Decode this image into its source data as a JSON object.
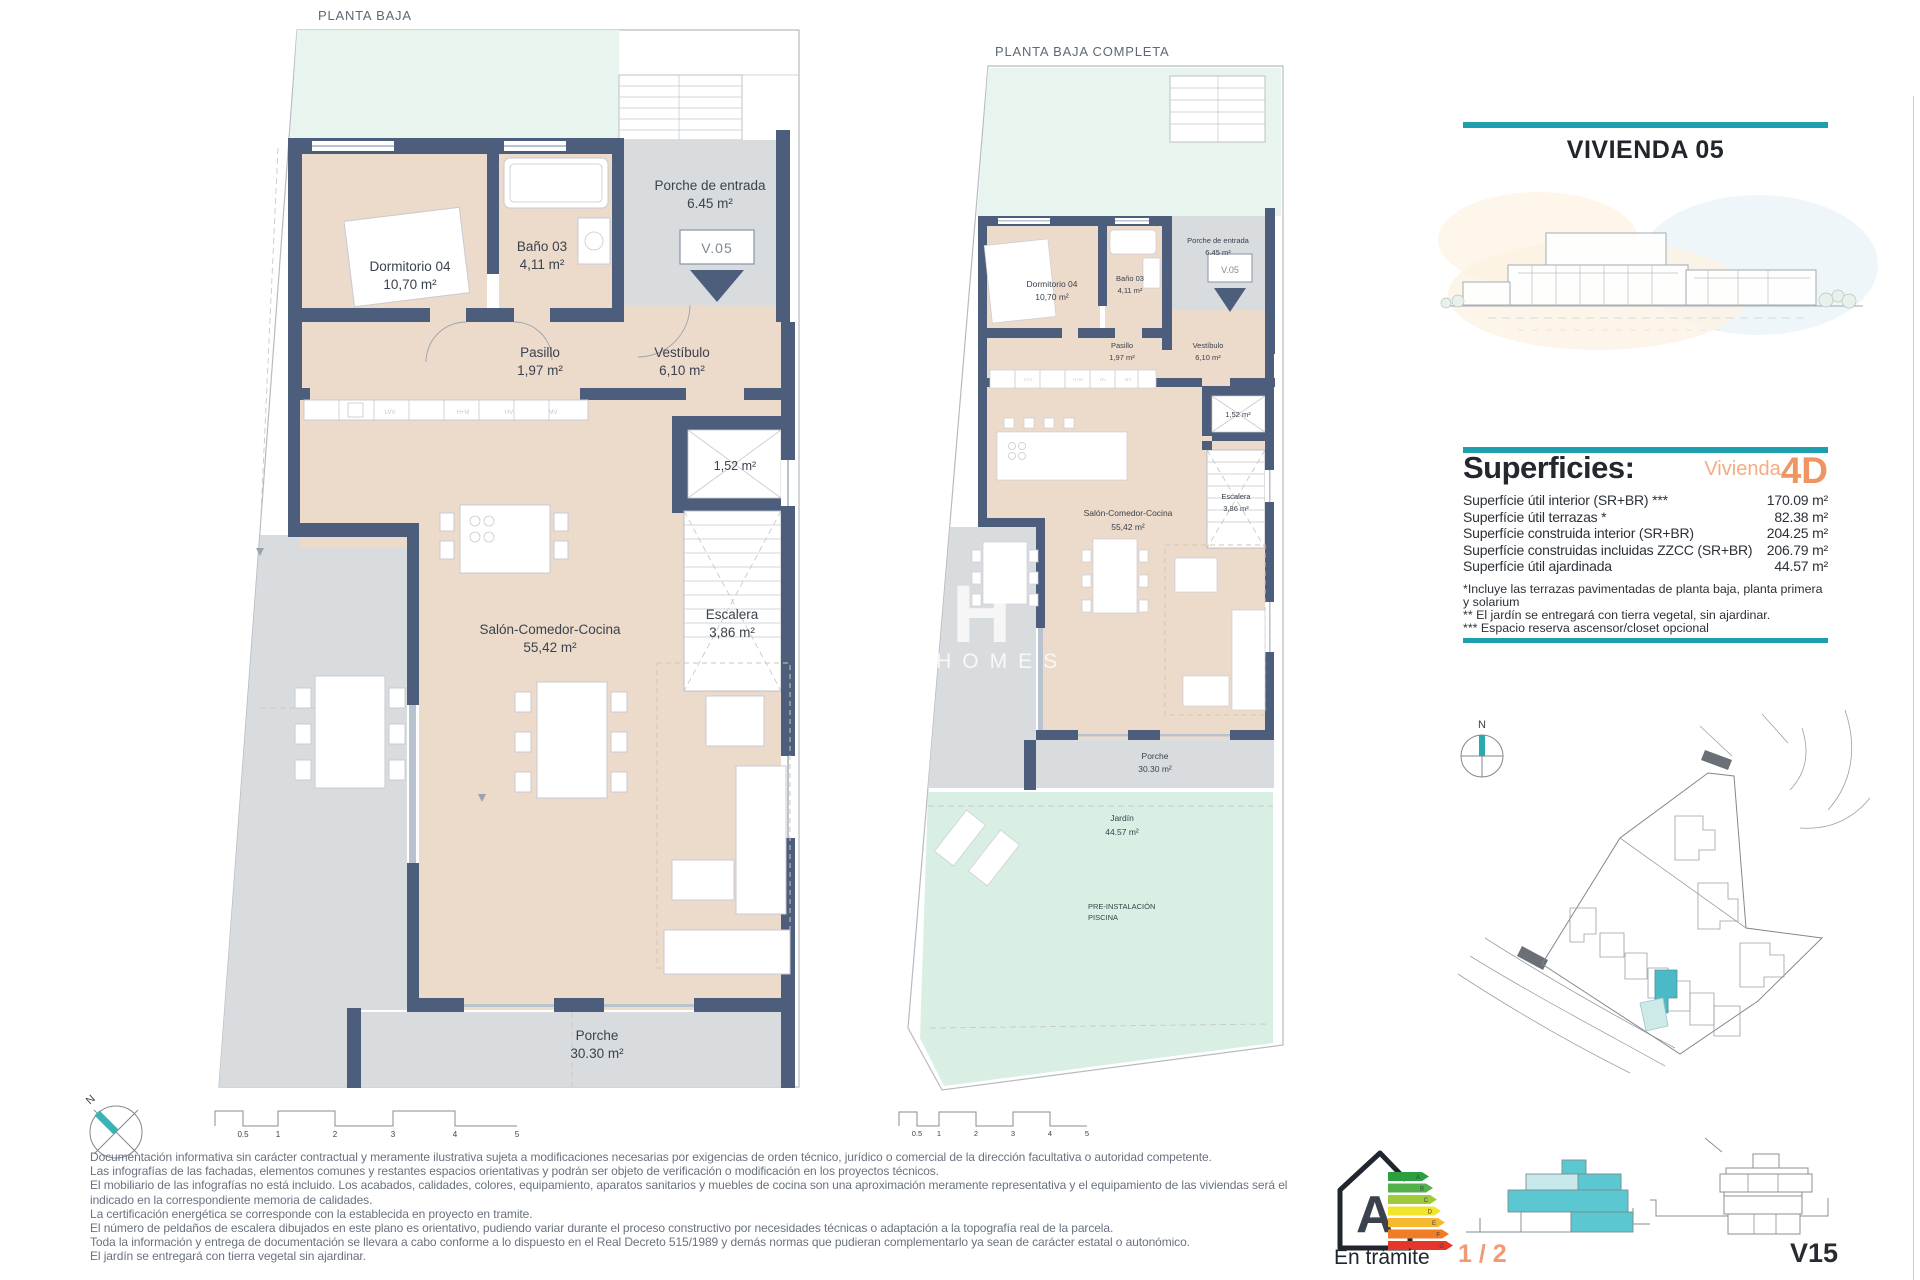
{
  "plans": {
    "plan_a_title": "PLANTA BAJA",
    "plan_b_title": "PLANTA BAJA COMPLETA"
  },
  "rooms": {
    "porche_entrada": {
      "name": "Porche de entrada",
      "area": "6.45 m²"
    },
    "unit_tag": "V.05",
    "dormitorio": {
      "name": "Dormitorio 04",
      "area": "10,70 m²"
    },
    "bano": {
      "name": "Baño 03",
      "area": "4,11 m²"
    },
    "pasillo": {
      "name": "Pasillo",
      "area": "1,97 m²"
    },
    "vestibulo": {
      "name": "Vestíbulo",
      "area": "6,10 m²"
    },
    "trastero_area": "1,52 m²",
    "salon": {
      "name": "Salón-Comedor-Cocina",
      "area": "55,42 m²"
    },
    "escalera": {
      "name": "Escalera",
      "area": "3,86 m²"
    },
    "porche": {
      "name": "Porche",
      "area": "30.30 m²"
    },
    "jardin": {
      "name": "Jardín",
      "area": "44.57 m²"
    },
    "pre_instalacion_line1": "PRE-INSTALACIÓN",
    "pre_instalacion_line2": "PISCINA"
  },
  "kitchen_labels": [
    "LVV",
    "H+M",
    "HV",
    "MV"
  ],
  "panel": {
    "title": "VIVIENDA 05",
    "superficies_heading": "Superficies:",
    "vivienda_word": "Vivienda",
    "vivienda_type": "4D",
    "rows": [
      {
        "label": "Superfície útil interior (SR+BR) ***",
        "value": "170.09 m²"
      },
      {
        "label": "Superfície útil terrazas *",
        "value": "82.38 m²"
      },
      {
        "label": "Superfície construida interior (SR+BR)",
        "value": "204.25 m²"
      },
      {
        "label": "Superfície construidas incluidas ZZCC (SR+BR)",
        "value": "206.79 m²"
      },
      {
        "label": "Superfície útil ajardinada",
        "value": "44.57 m²"
      }
    ],
    "footnotes": [
      "*Incluye las terrazas pavimentadas de planta baja, planta primera y solarium",
      "** El jardín se entregará con tierra vegetal, sin ajardinar.",
      "*** Espacio reserva ascensor/closet opcional"
    ]
  },
  "compass": {
    "north": "N"
  },
  "scalebar": {
    "ticks": [
      "0.5",
      "1",
      "2",
      "3",
      "4",
      "5"
    ]
  },
  "disclaimer": {
    "lines": [
      "Documentación informativa sin carácter contractual y meramente ilustrativa sujeta a modificaciones necesarias por exigencias de orden técnico, jurídico o comercial de la dirección facultativa o autoridad competente.",
      "Las infografías de las fachadas, elementos comunes y restantes espacios orientativas y podrán ser objeto de verificación o modificación en los proyectos técnicos.",
      "El mobiliario de las infografías no está incluido. Los acabados, calidades, colores, equipamiento, aparatos sanitarios y muebles de cocina son una aproximación meramente representativa y el equipamiento de las viviendas será el",
      "indicado en la correspondiente memoria de calidades.",
      "La certificación energética se corresponde con la establecida en proyecto en tramite.",
      "El número de peldaños de escalera dibujados en este plano es orientativo, pudiendo variar durante el proceso constructivo por necesidades técnicas o adaptación a la topografía real de la parcela.",
      "Toda la información y entrega de documentación se llevara a cabo conforme a lo dispuesto en el Real Decreto 515/1989 y demás normas que pudieran complementarlo ya sean de carácter estatal o autonómico.",
      "El jardín se entregará con tierra vegetal sin ajardinar."
    ]
  },
  "energy": {
    "rating": "A",
    "status": "En trámite",
    "scale": [
      "A",
      "B",
      "C",
      "D",
      "E",
      "F",
      "G"
    ]
  },
  "footer": {
    "page": "1 / 2",
    "sheet": "V15"
  },
  "watermark": {
    "letter": "H",
    "text": "ITY HOMES"
  }
}
